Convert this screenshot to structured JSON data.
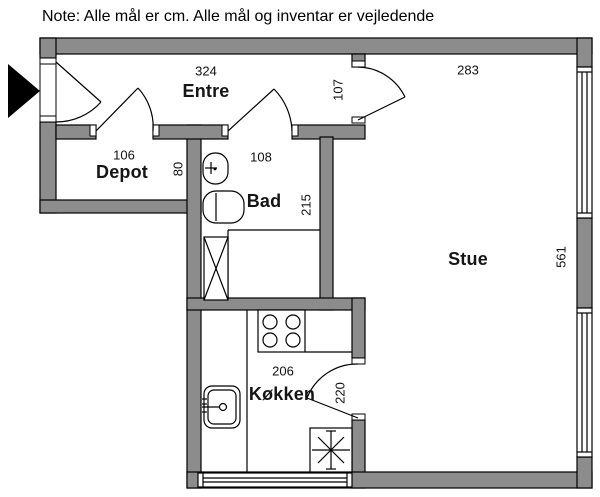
{
  "note": "Note: Alle mål er cm. Alle mål og inventar er vejledende",
  "rooms": {
    "entre": {
      "label": "Entre",
      "width": "324",
      "door_side": "107"
    },
    "depot": {
      "label": "Depot",
      "width": "106",
      "depth": "80"
    },
    "bad": {
      "label": "Bad",
      "width": "108",
      "depth": "215"
    },
    "stue": {
      "label": "Stue",
      "width": "283",
      "depth": "561"
    },
    "koekken": {
      "label": "Køkken",
      "width": "206",
      "door_side": "220"
    }
  },
  "colors": {
    "wall_fill": "#8c8c8c",
    "line": "#000000",
    "background": "#ffffff",
    "text": "#000000"
  }
}
